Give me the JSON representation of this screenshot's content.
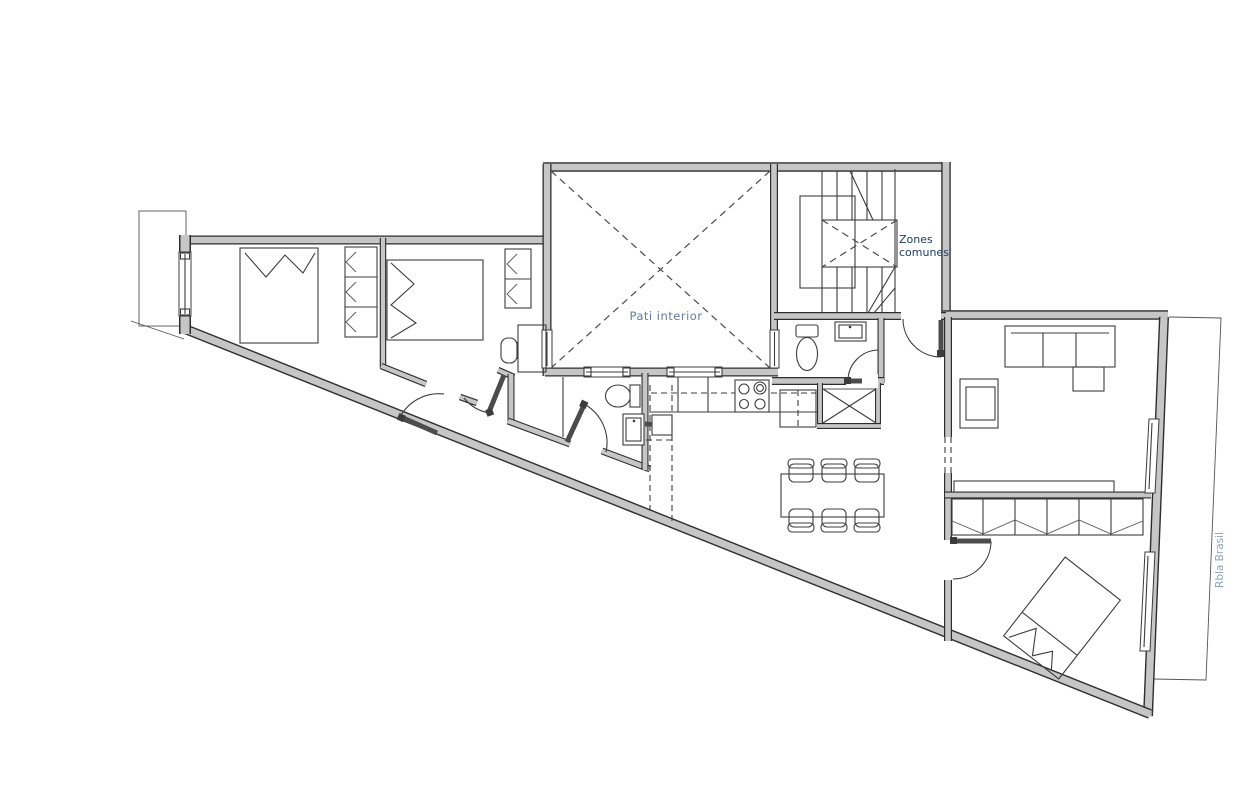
{
  "labels": {
    "patio": "Pati interior",
    "common_zones_line1": "Zones",
    "common_zones_line2": "comunes",
    "street": "Rbla Brasil"
  },
  "colors": {
    "background": "#ffffff",
    "wall_fill": "#c6c6c6",
    "wall_edge": "#2d2d2d",
    "line": "#3c3c3c",
    "patio_label": "#5f7da1",
    "common_zones_label": "#1d3c63",
    "street_label": "#8ca3bc"
  }
}
